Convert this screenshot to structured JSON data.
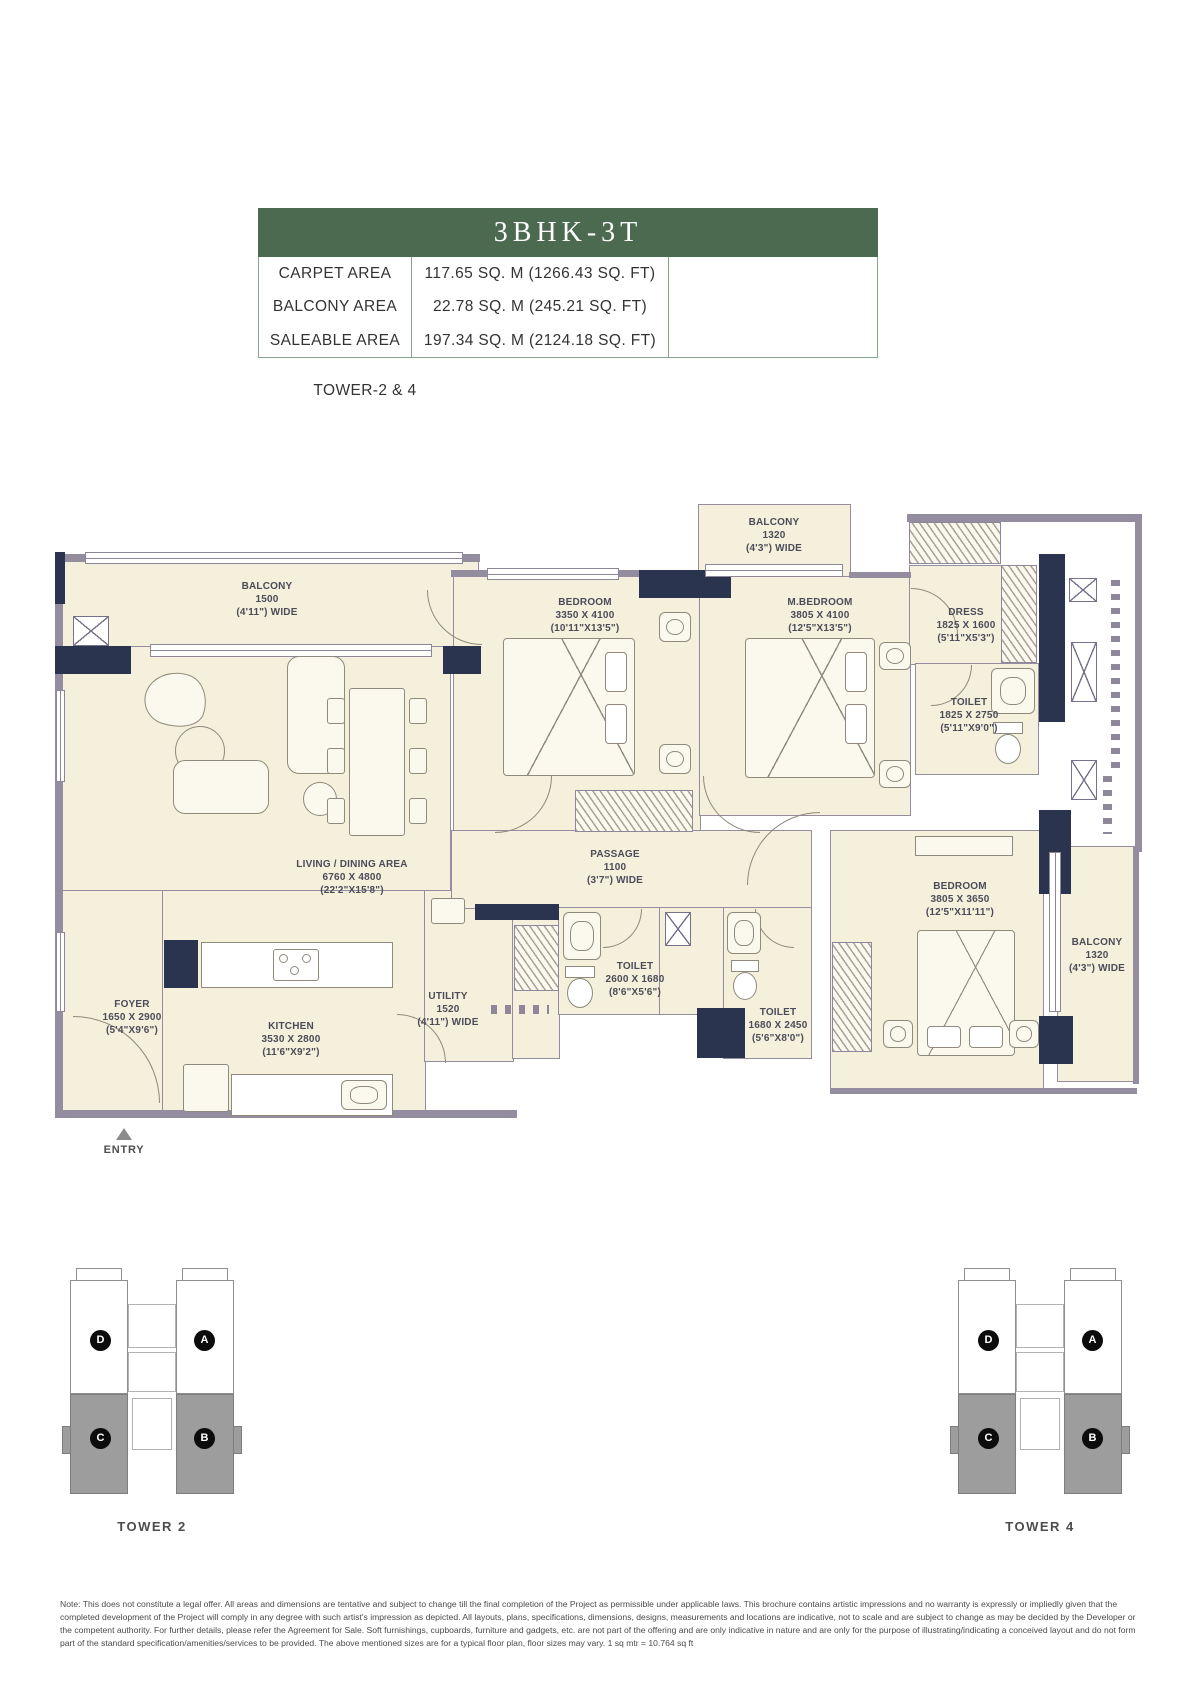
{
  "header": {
    "title": "3BHK-3T",
    "rows": [
      {
        "label": "CARPET AREA",
        "value": "117.65 SQ. M (1266.43 SQ. FT)"
      },
      {
        "label": "BALCONY AREA",
        "value": "22.78 SQ. M (245.21 SQ. FT)"
      },
      {
        "label": "SALEABLE AREA",
        "value": "197.34 SQ. M (2124.18 SQ. FT)"
      }
    ],
    "tower_cell": "TOWER-2 & 4"
  },
  "plan": {
    "entry_label": "ENTRY",
    "rooms": {
      "balcony_left": {
        "name": "BALCONY",
        "dim": "1500",
        "imp": "(4'11\") WIDE"
      },
      "living": {
        "name": "LIVING / DINING AREA",
        "dim": "6760 X 4800",
        "imp": "(22'2\"X15'8\")"
      },
      "bedroom_top": {
        "name": "BEDROOM",
        "dim": "3350 X 4100",
        "imp": "(10'11\"X13'5\")"
      },
      "balcony_top": {
        "name": "BALCONY",
        "dim": "1320",
        "imp": "(4'3\") WIDE"
      },
      "mbedroom": {
        "name": "M.BEDROOM",
        "dim": "3805 X 4100",
        "imp": "(12'5\"X13'5\")"
      },
      "dress": {
        "name": "DRESS",
        "dim": "1825 X 1600",
        "imp": "(5'11\"X5'3\")"
      },
      "mtoilet": {
        "name": "TOILET",
        "dim": "1825 X 2750",
        "imp": "(5'11\"X9'0\")"
      },
      "passage": {
        "name": "PASSAGE",
        "dim": "1100",
        "imp": "(3'7\") WIDE"
      },
      "toilet_common": {
        "name": "TOILET",
        "dim": "2600 X 1680",
        "imp": "(8'6\"X5'6\")"
      },
      "toilet_3": {
        "name": "TOILET",
        "dim": "1680 X 2450",
        "imp": "(5'6\"X8'0\")"
      },
      "utility": {
        "name": "UTILITY",
        "dim": "1520",
        "imp": "(4'11\") WIDE"
      },
      "foyer": {
        "name": "FOYER",
        "dim": "1650 X 2900",
        "imp": "(5'4\"X9'6\")"
      },
      "kitchen": {
        "name": "KITCHEN",
        "dim": "3530 X 2800",
        "imp": "(11'6\"X9'2\")"
      },
      "bedroom_br": {
        "name": "BEDROOM",
        "dim": "3805 X 3650",
        "imp": "(12'5\"X11'11\")"
      },
      "balcony_right": {
        "name": "BALCONY",
        "dim": "1320",
        "imp": "(4'3\") WIDE"
      }
    }
  },
  "towers": [
    {
      "caption": "TOWER 2",
      "units": [
        "D",
        "A",
        "C",
        "B"
      ]
    },
    {
      "caption": "TOWER 4",
      "units": [
        "D",
        "A",
        "C",
        "B"
      ]
    }
  ],
  "note": "Note: This does not constitute a legal offer. All areas and dimensions are tentative and subject to change till the final completion of the Project as permissible under applicable laws. This brochure contains artistic impressions and no warranty is expressly or impliedly given that the completed development of the Project will comply in any degree with such artist's impression as depicted. All layouts, plans, specifications, dimensions, designs, measurements and locations are indicative, not to scale and are subject to change as may be decided by the Developer or the competent authority. For further details, please refer the Agreement for Sale. Soft furnishings, cupboards, furniture and gadgets, etc. are not part of the offering and are only indicative in nature and are only for the purpose of illustrating/indicating a conceived layout and do not form part of the standard specification/amenities/services to be provided. The above mentioned sizes are for a typical floor plan, floor sizes may vary. 1 sq mtr = 10.764 sq ft",
  "colors": {
    "banner_green": "#4c6a50",
    "wall_navy": "#2b344e",
    "wall_gray": "#948da0",
    "room_cream": "#f4f0db",
    "shaded_unit_gray": "#9d9d9d"
  }
}
